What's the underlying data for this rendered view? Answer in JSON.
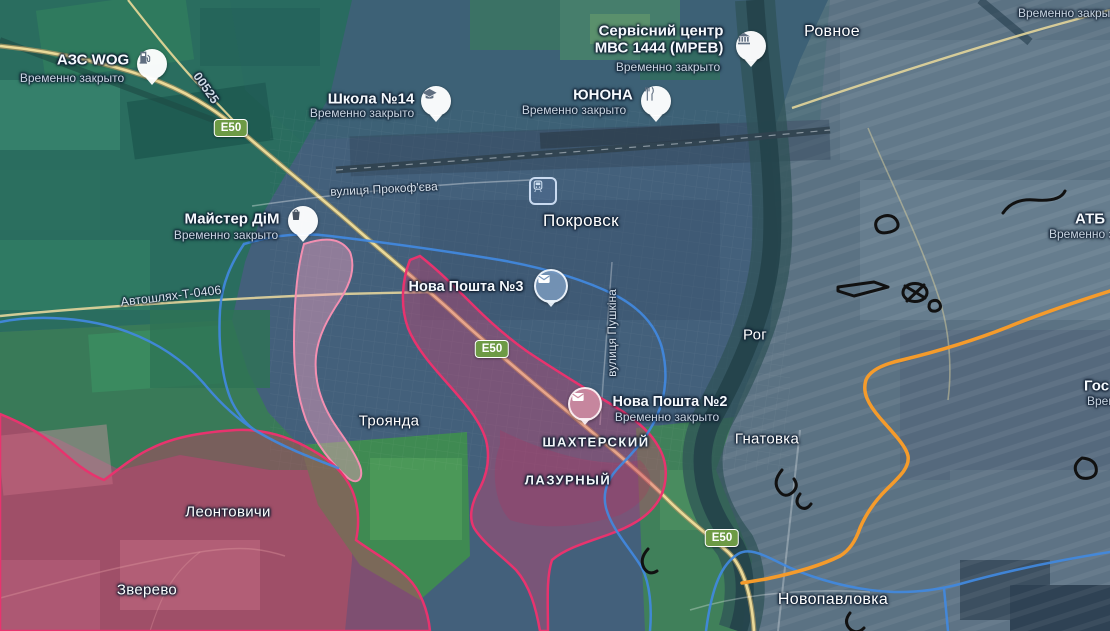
{
  "badges": {
    "e50": "E50",
    "route_00525": "00525"
  },
  "streets": {
    "prokofieva": "вулиця Прокоф'єва",
    "avtoshliakh_t0406": "Автошлях-Т-0406",
    "pushkina": "вулиця Пушкіна"
  },
  "towns": {
    "rovnoe": "Ровное",
    "pokrovsk": "Покровск",
    "rog": "Рог",
    "hnatovka": "Гнатовка",
    "troianda": "Троянда",
    "leontovychi": "Леонтовичи",
    "zverevo": "Зверево",
    "novopavlovka": "Новопавловка"
  },
  "districts": {
    "shakhterskii": "ШАХТЕРСКИЙ",
    "lazurnyi": "ЛАЗУРНЫЙ"
  },
  "pois": {
    "azs_wog": {
      "name": "АЗС WOG",
      "status": "Временно закрыто",
      "icon": "fuel-pump"
    },
    "shkola14": {
      "name": "Школа №14",
      "status": "Временно закрыто",
      "icon": "school"
    },
    "mvs_service_center": {
      "name_line1": "Сервісний центр",
      "name_line2": "МВС 1444 (МРЕВ)",
      "status": "Временно закрыто",
      "icon": "government-building"
    },
    "yunona": {
      "name": "ЮНОНА",
      "status": "Временно закрыто",
      "icon": "restaurant"
    },
    "maister_dim": {
      "name": "Майстер ДіМ",
      "status": "Временно закрыто",
      "icon": "shopping-bag"
    },
    "nova_poshta3": {
      "name": "Нова Пошта №3",
      "icon": "post-envelope"
    },
    "nova_poshta2": {
      "name": "Нова Пошта №2",
      "status": "Временно закрыто",
      "icon": "post-envelope"
    },
    "train_station": {
      "icon": "train-station"
    }
  },
  "edge_labels": {
    "top_right_status": "Временно закрыто",
    "atb": "АТБ",
    "atb_status": "Временно закрыто",
    "gos": "Гос",
    "gos_status": "Временно закрыто"
  },
  "colors": {
    "friendly_boundary_line": "#4189e0",
    "front_line_orange": "#f59b2b",
    "assault_zone_border": "#e8336e",
    "assault_zone_fill": "rgba(222,60,110,0.38)",
    "contested_zone_fill": "rgba(250,165,195,0.42)",
    "fortification_marks": "#111111",
    "road_badge_green": "#6d9a45"
  }
}
